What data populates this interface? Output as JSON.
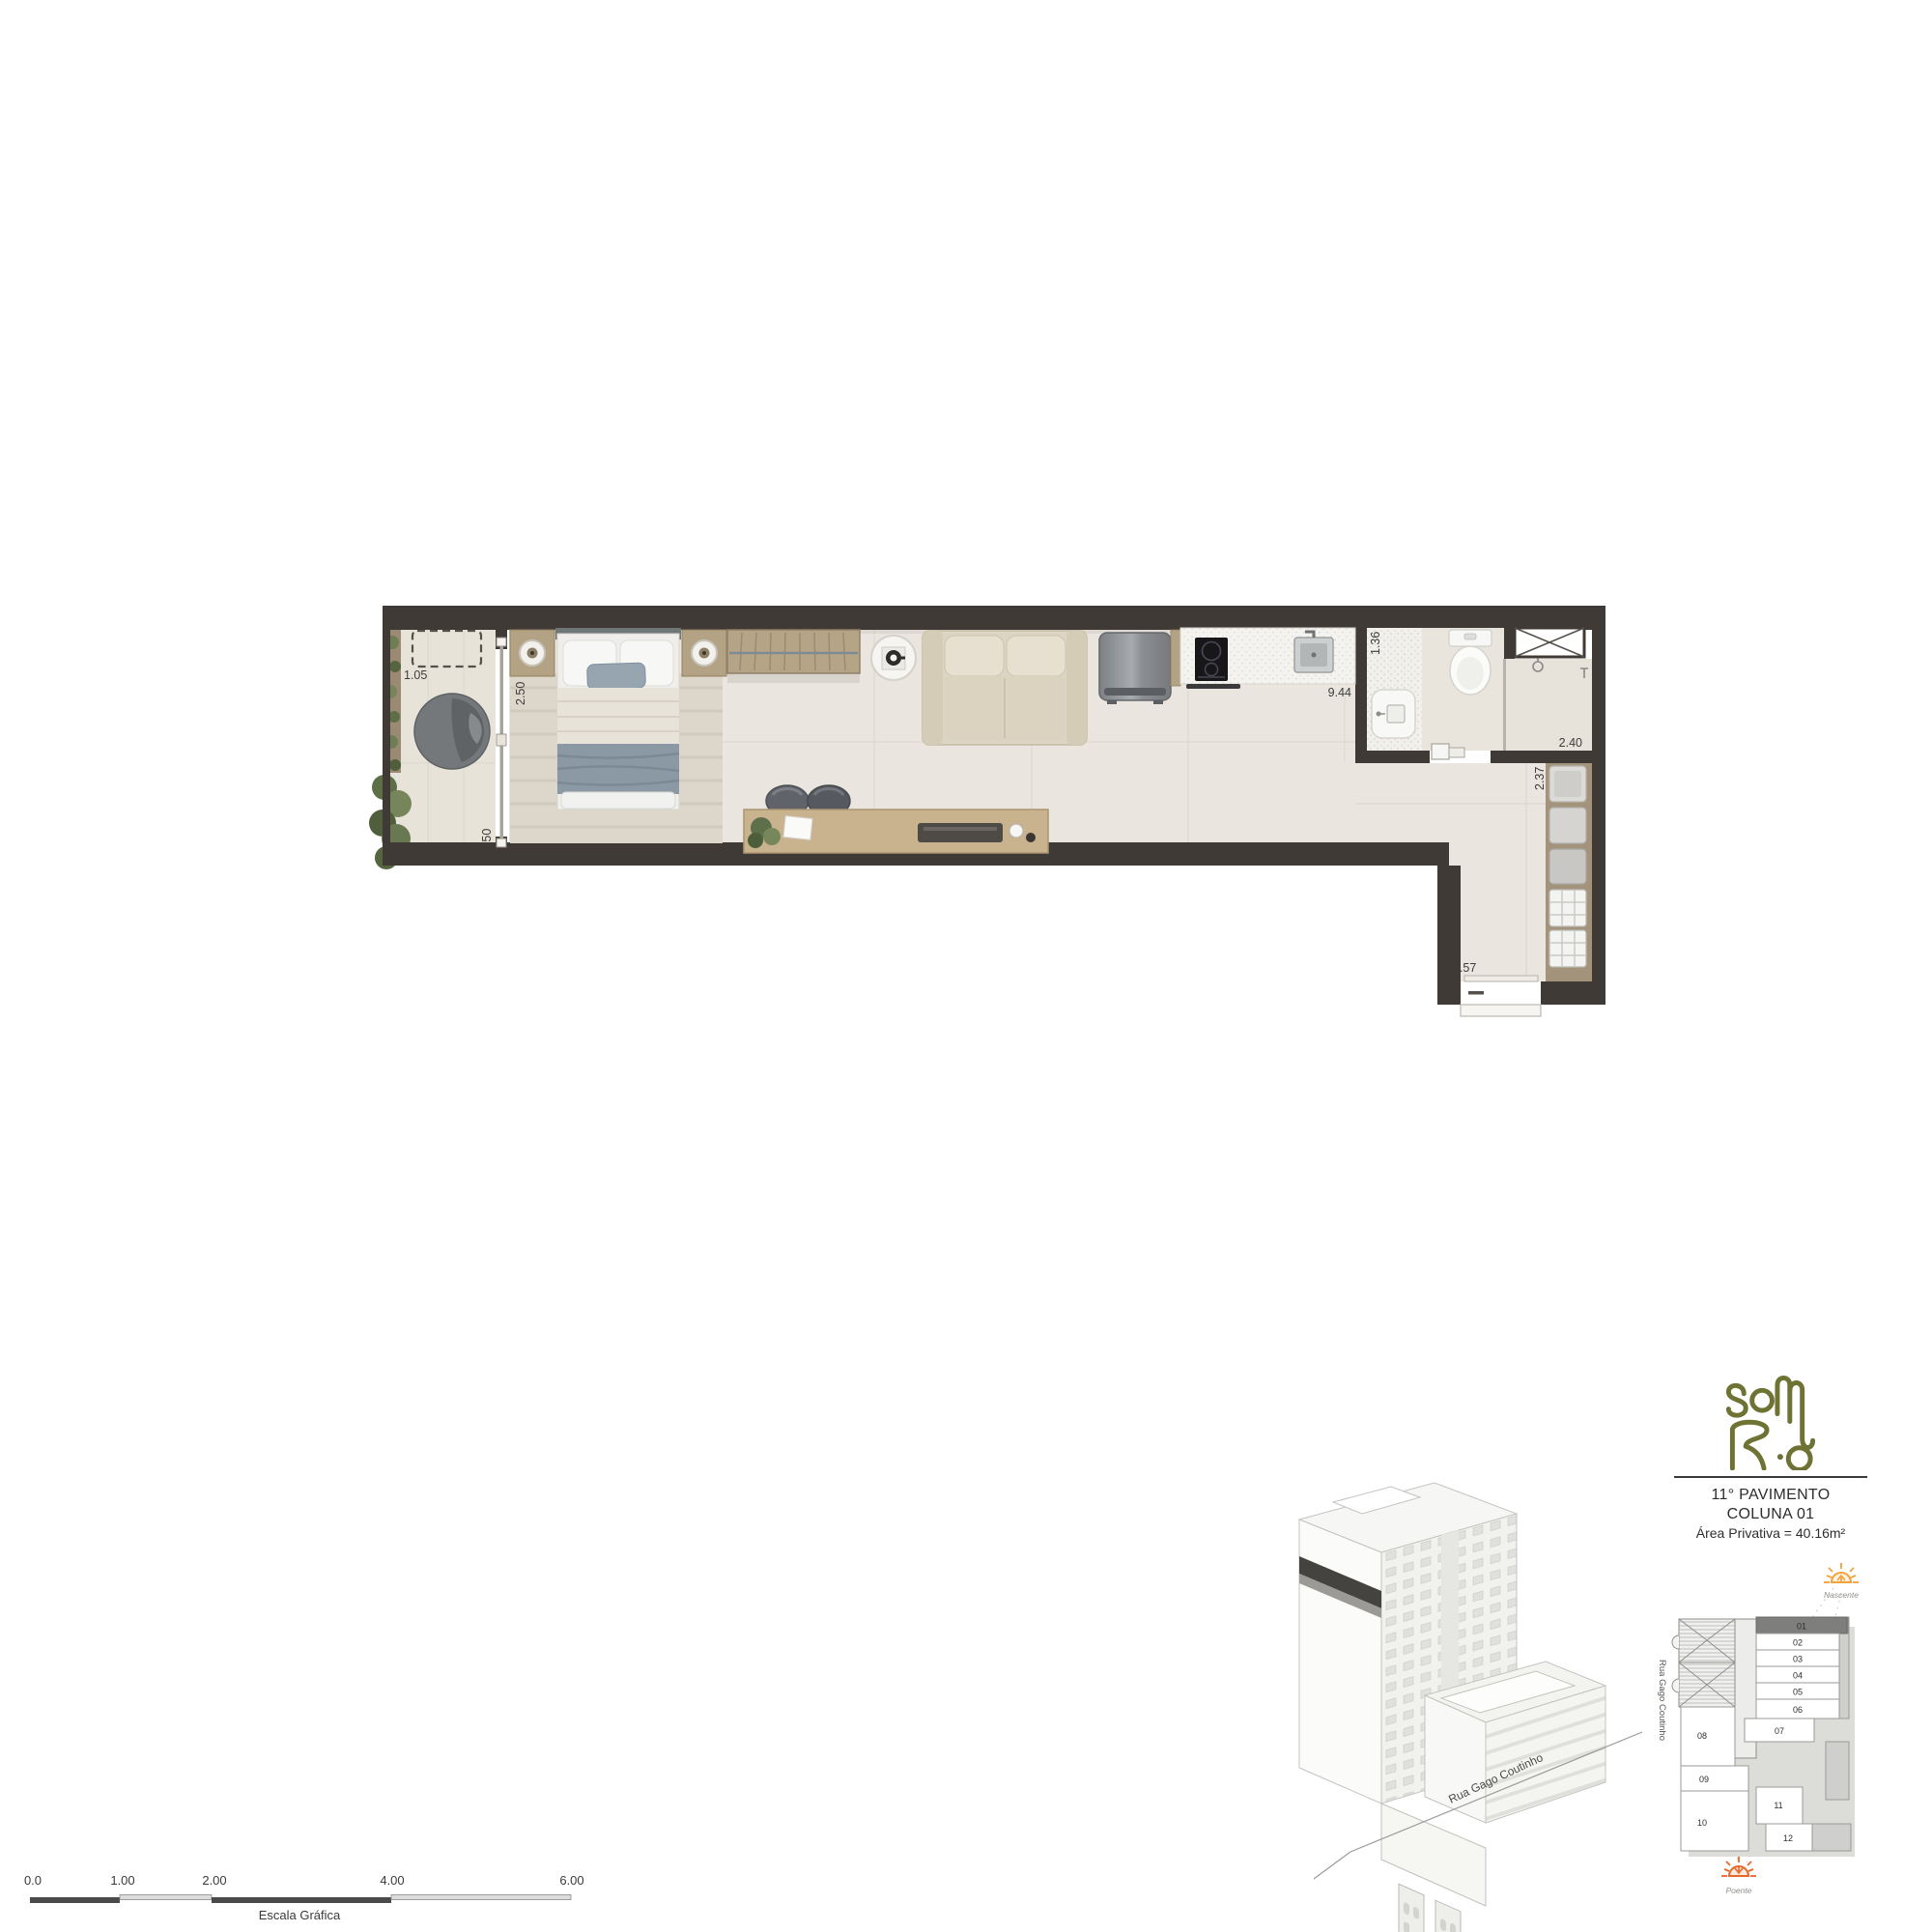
{
  "plan": {
    "dims": {
      "balcony_width": "1.05",
      "bedroom_depth": "2.50",
      "balcony_depth": "2.50",
      "kitchen_width": "1.36",
      "living_length": "9.44",
      "bathroom_width": "2.40",
      "hall_depth": "2.37",
      "apartment_length": "10.52",
      "entry_width": "1.57"
    },
    "wall_color": "#3f3a35",
    "floor_color": "#eae6df"
  },
  "branding": {
    "brand": "Sol Rio",
    "logo_color": "#6e7233"
  },
  "info": {
    "floor": "11° PAVIMENTO",
    "column": "COLUNA 01",
    "area": "Área Privativa = 40.16m²"
  },
  "keyplan": {
    "units": [
      "01",
      "02",
      "03",
      "04",
      "05",
      "06",
      "07",
      "08",
      "09",
      "10",
      "11",
      "12"
    ],
    "highlighted_unit": "01",
    "orientation_east": "Nascente",
    "orientation_west": "Poente",
    "street": "Rua Gago Coutinho",
    "sun_east_color": "#f2a13b",
    "sun_west_color": "#e8662a"
  },
  "building": {
    "street": "Rua Gago Coutinho"
  },
  "scalebar": {
    "ticks": [
      "0.0",
      "1.00",
      "2.00",
      "4.00",
      "6.00"
    ],
    "caption": "Escala Gráfica"
  }
}
